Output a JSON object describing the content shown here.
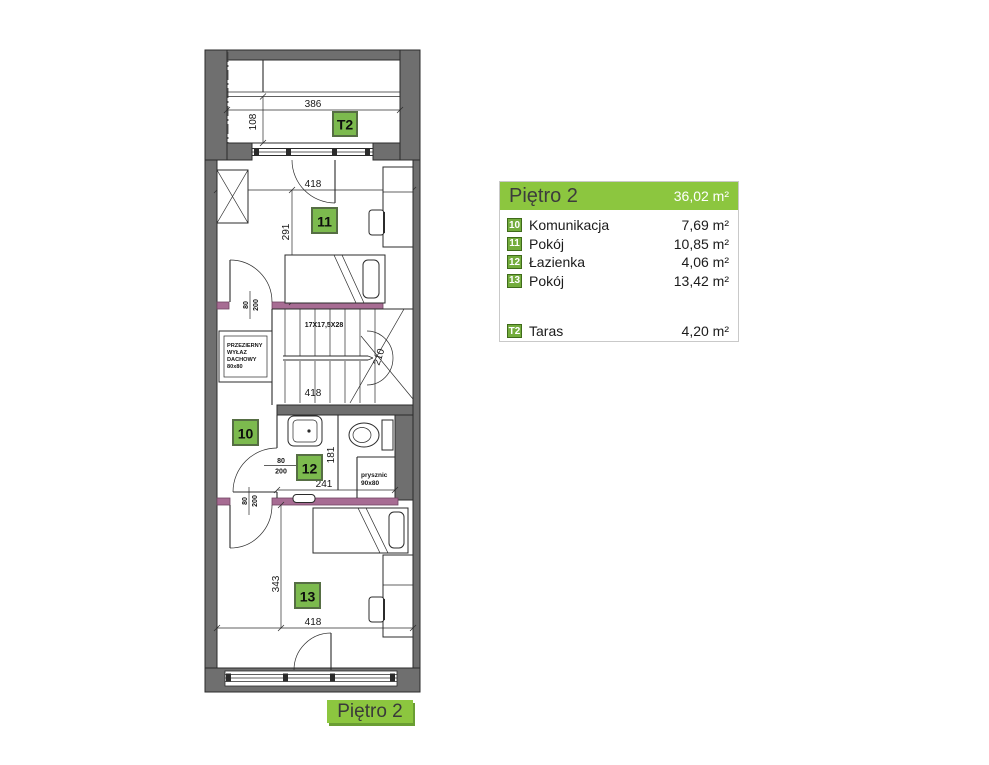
{
  "colors": {
    "accent_green": "#8CC63F",
    "badge_green": "#73AC3C",
    "plan_badge_green": "#7CBA4E",
    "wall_grey": "#6F6F6F",
    "highlight_wall_purple": "#A76C93"
  },
  "legend": {
    "title": "Piętro 2",
    "total_area": "36,02 m²",
    "rooms": [
      {
        "badge": "10",
        "label": "Komunikacja",
        "area": "7,69 m²"
      },
      {
        "badge": "11",
        "label": "Pokój",
        "area": "10,85 m²"
      },
      {
        "badge": "12",
        "label": "Łazienka",
        "area": "4,06 m²"
      },
      {
        "badge": "13",
        "label": "Pokój",
        "area": "13,42 m²"
      }
    ],
    "extra": {
      "badge": "T2",
      "label": "Taras",
      "area": "4,20 m²"
    }
  },
  "caption": "Piętro 2",
  "plan": {
    "badges": {
      "terrace": "T2",
      "hall": "10",
      "room11": "11",
      "bath": "12",
      "room13": "13"
    },
    "dims": {
      "terrace_width": "386",
      "terrace_depth": "108",
      "room11_width": "418",
      "room11_depth": "291",
      "stairs_label": "17X17,5X28",
      "stairs_run": "210",
      "stairs_width": "418",
      "bath_depth": "181",
      "bath_width": "241",
      "room13_depth": "343",
      "room13_width": "418",
      "door_width": "80",
      "door_height": "200"
    },
    "roof_hatch": {
      "line1": "PRZEZIERNY",
      "line2": "WYŁAZ",
      "line3": "DACHOWY",
      "line4": "80x80"
    },
    "shower": {
      "line1": "prysznic",
      "line2": "90x80"
    }
  }
}
